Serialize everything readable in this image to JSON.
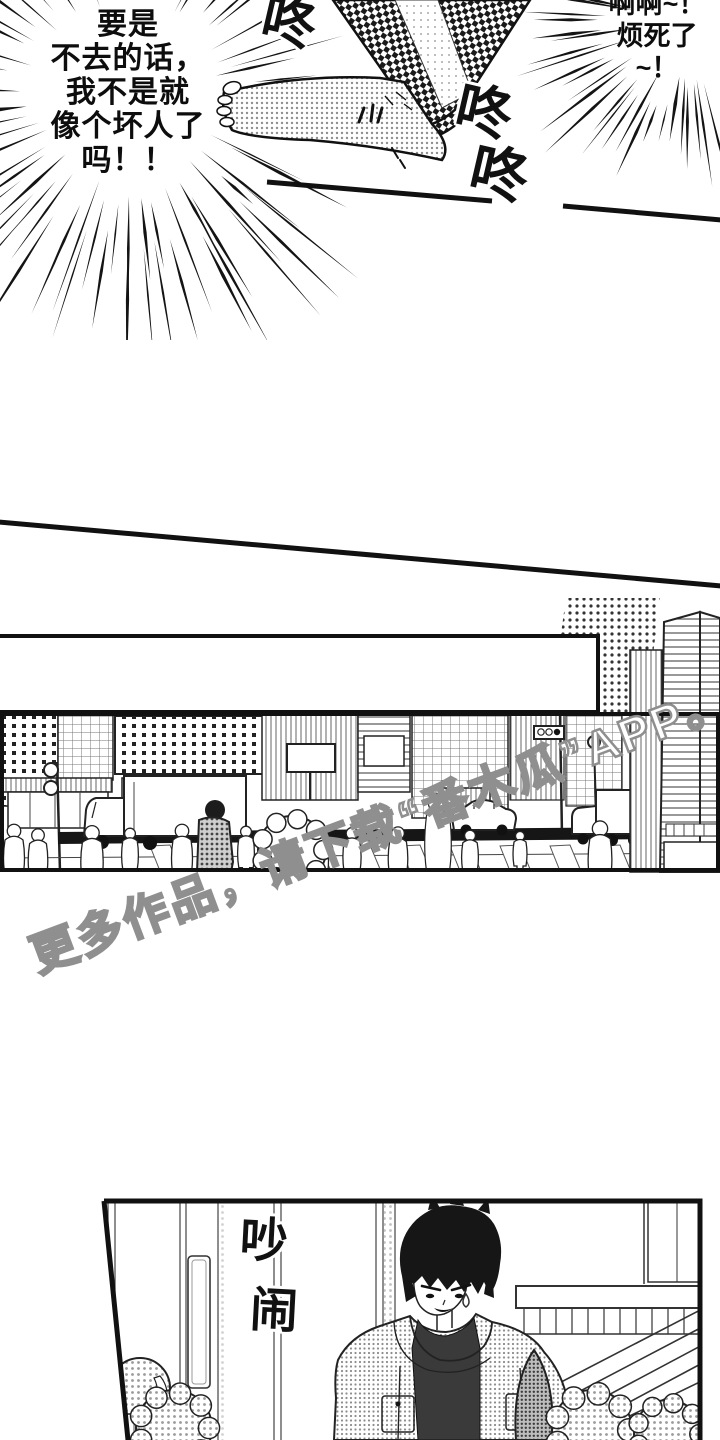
{
  "page": {
    "background": "#ffffff",
    "ink": "#111111"
  },
  "top_section": {
    "burst_bubble_left": {
      "lines": [
        "要是",
        "不去的话，",
        "我不是就",
        "像个坏人了",
        "吗！！"
      ]
    },
    "burst_bubble_right": {
      "lines": [
        "啊啊~！",
        "烦死了",
        "~！"
      ]
    },
    "sfx": {
      "thud_1": "咚",
      "thud_2": "咚",
      "thud_3": "咚"
    }
  },
  "city_panel": {
    "caption_box_text": ""
  },
  "bottom_panel": {
    "sfx": {
      "noise_top": "吵",
      "noise_bottom": "闹"
    }
  },
  "watermark": {
    "text": "更多作品，请下载“番木瓜”APP。",
    "fill_color": "#ffffff",
    "outline_color": "#8f8f8f"
  }
}
